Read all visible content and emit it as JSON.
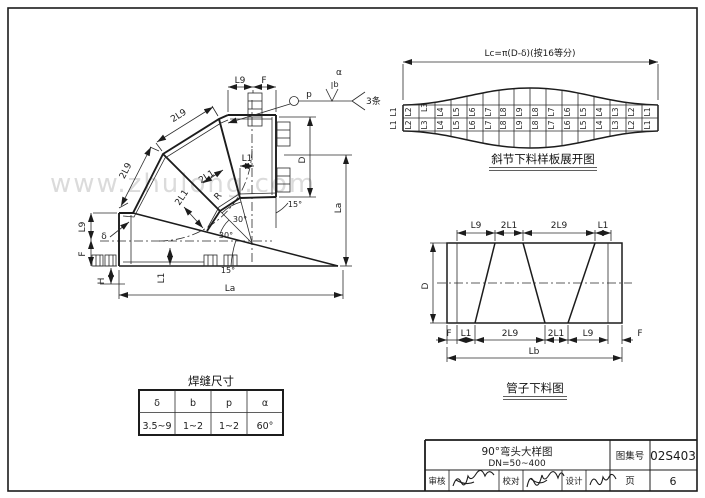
{
  "watermark": "www.zhulong.com",
  "elbow": {
    "labels": {
      "two_l9": "2L9",
      "two_l1": "2L1",
      "l9": "L9",
      "l1": "L1",
      "f": "F",
      "d": "D",
      "la": "La",
      "r": "R",
      "delta": "δ",
      "h": "H",
      "b": "b",
      "p": "p",
      "alpha": "α",
      "deg30": "30°",
      "deg15": "15°",
      "welds": "3条"
    }
  },
  "development": {
    "length_formula": "Lc=π(D-δ)(按16等分)",
    "caption": "斜节下料样板展开图",
    "labels": [
      "L1",
      "L2",
      "L3",
      "L4",
      "L5",
      "L6",
      "L7",
      "L8",
      "L9",
      "L8",
      "L7",
      "L6",
      "L5",
      "L4",
      "L3",
      "L2",
      "L1"
    ]
  },
  "blank": {
    "caption": "管子下料图",
    "d": "D",
    "lb": "Lb",
    "top": [
      "L9",
      "2L1",
      "2L9",
      "L1"
    ],
    "bottom": [
      "F",
      "L1",
      "2L9",
      "2L1",
      "L9",
      "F"
    ]
  },
  "weld_table": {
    "title": "焊缝尺寸",
    "headers": [
      "δ",
      "b",
      "p",
      "α"
    ],
    "rows": [
      [
        "3.5~9",
        "1~2",
        "1~2",
        "60°"
      ]
    ]
  },
  "title_block": {
    "title": "90°弯头大样图",
    "subtitle": "DN=50~400",
    "atlas_label": "图集号",
    "atlas_no": "02S403",
    "page_label": "页",
    "page_no": "6",
    "check_label": "审核",
    "proof_label": "校对",
    "design_label": "设计"
  }
}
